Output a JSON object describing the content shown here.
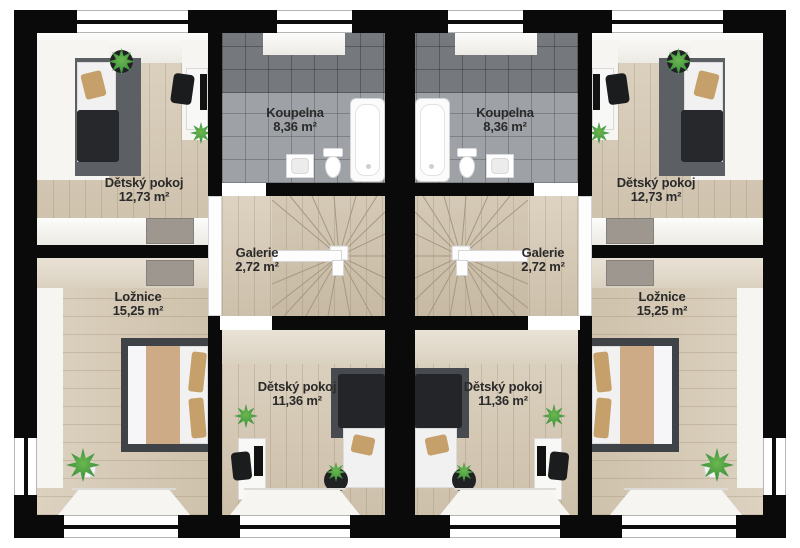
{
  "palette": {
    "wall": "#0a0a0a",
    "wood": "#d5c8b2",
    "wood-light": "#e0d8ca",
    "tile": "#9ea1a6",
    "tile-dark": "#75787d",
    "rug": "#5c6065",
    "rug-dark": "#3f4347",
    "duvet": "#26282b",
    "pillow": "#c5a06a",
    "blanket": "#cdab87",
    "plant": "#3f9440",
    "pot": "#202122",
    "label": "#2a2a2a"
  },
  "units": [
    {
      "side": "left",
      "rooms": [
        {
          "id": "detsky-pokoj-horni",
          "name": "Dětský pokoj",
          "area": "12,73 m²"
        },
        {
          "id": "koupelna",
          "name": "Koupelna",
          "area": "8,36 m²"
        },
        {
          "id": "galerie",
          "name": "Galerie",
          "area": "2,72 m²"
        },
        {
          "id": "loznice",
          "name": "Ložnice",
          "area": "15,25 m²"
        },
        {
          "id": "detsky-pokoj-dolni",
          "name": "Dětský pokoj",
          "area": "11,36 m²"
        }
      ]
    },
    {
      "side": "right",
      "rooms": [
        {
          "id": "detsky-pokoj-horni",
          "name": "Dětský pokoj",
          "area": "12,73 m²"
        },
        {
          "id": "koupelna",
          "name": "Koupelna",
          "area": "8,36 m²"
        },
        {
          "id": "galerie",
          "name": "Galerie",
          "area": "2,72 m²"
        },
        {
          "id": "loznice",
          "name": "Ložnice",
          "area": "15,25 m²"
        },
        {
          "id": "detsky-pokoj-dolni",
          "name": "Dětský pokoj",
          "area": "11,36 m²"
        }
      ]
    }
  ]
}
